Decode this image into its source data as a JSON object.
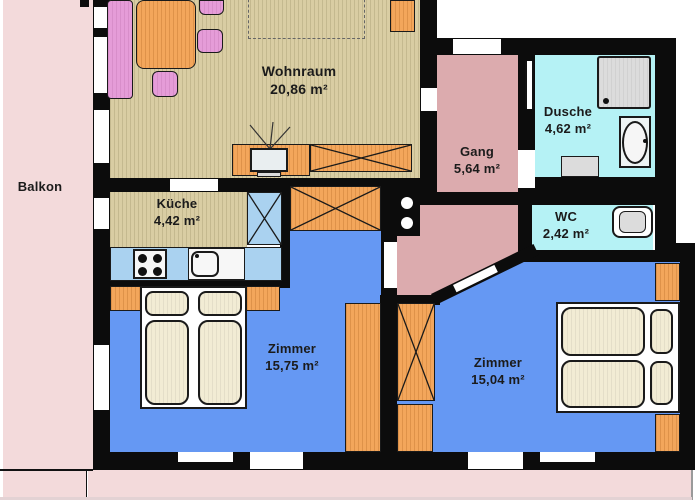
{
  "plan": {
    "type": "apartment-floor-plan",
    "labels": {
      "balkon": {
        "name": "Balkon"
      },
      "wohnraum": {
        "name": "Wohnraum",
        "area": "20,86 m²"
      },
      "kueche": {
        "name": "Küche",
        "area": "4,42 m²"
      },
      "gang": {
        "name": "Gang",
        "area": "5,64 m²"
      },
      "dusche": {
        "name": "Dusche",
        "area": "4,62 m²"
      },
      "wc": {
        "name": "WC",
        "area": "2,42 m²"
      },
      "zimmer_links": {
        "name": "Zimmer",
        "area": "15,75 m²"
      },
      "zimmer_rechts": {
        "name": "Zimmer",
        "area": "15,04 m²"
      }
    },
    "colors": {
      "wall": "#0c0c0c",
      "balcony_floor": "#f3dadb",
      "living_floor": "#d9cda3",
      "hall_floor": "#dcabae",
      "bath_floor": "#b5f2f5",
      "bedroom_floor": "#6598f3",
      "kitchen_counter": "#aad2f0",
      "furniture_orange": "#f3a65b",
      "furniture_pink": "#e59cd8",
      "mattress_cream": "#f2ecd4",
      "fixture_gray": "#dcdcdc"
    },
    "fixtures": [
      "sofa",
      "dining-table",
      "chairs",
      "tv",
      "sideboard",
      "wardrobes",
      "fridge",
      "stove",
      "kitchen-sink",
      "double-bed",
      "shower",
      "bath-sink",
      "radiator",
      "toilet",
      "washer"
    ]
  }
}
